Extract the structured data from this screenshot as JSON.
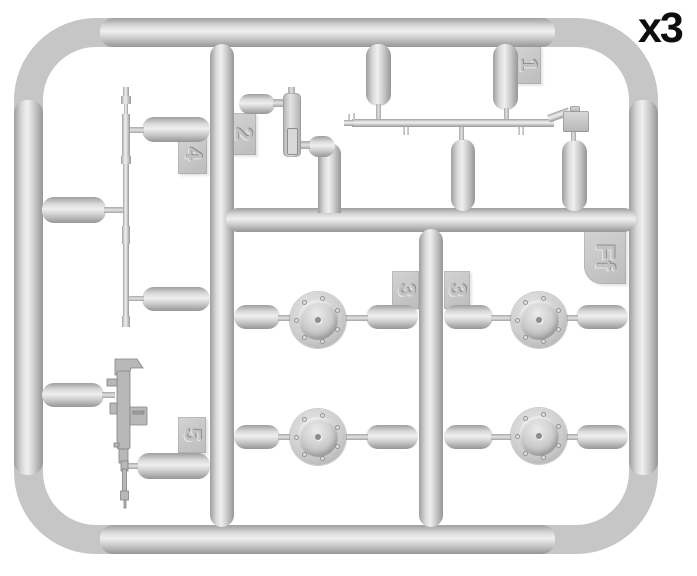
{
  "quantity_label": "x3",
  "sprue": {
    "id_tag": "Ff",
    "tags": {
      "t1": "1",
      "t2": "2",
      "t3a": "3",
      "t3b": "3",
      "t4": "4",
      "t5": "5"
    },
    "colors": {
      "plastic": "#c6c6c6",
      "plastic_highlight": "#efefef",
      "plastic_shadow": "#969696",
      "background": "#ffffff",
      "label_text": "#0d0d0d"
    }
  }
}
